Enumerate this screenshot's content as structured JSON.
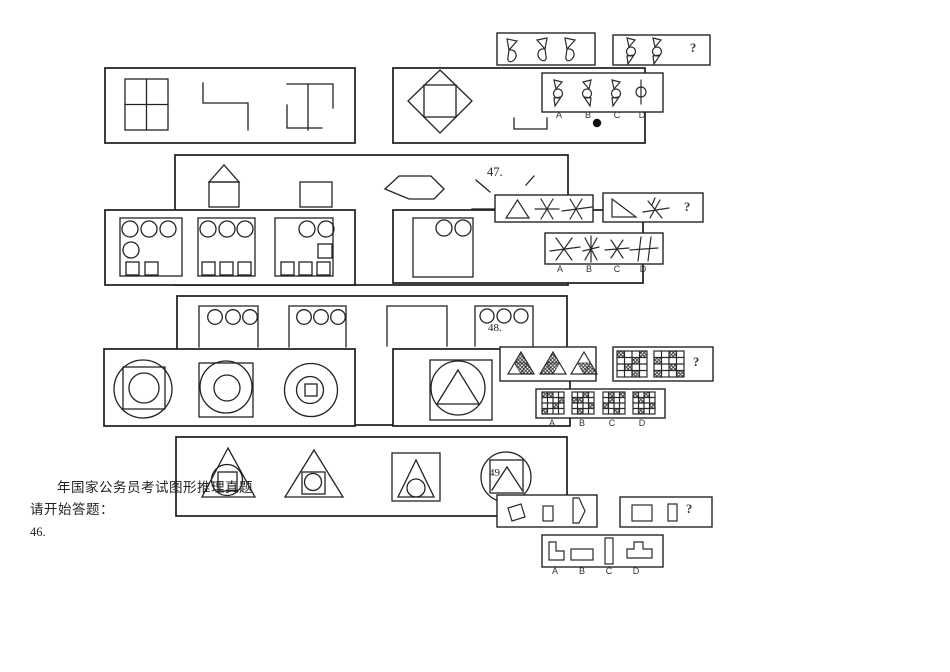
{
  "document": {
    "heading": "年国家公务员考试图形推理真题",
    "start_prompt": "请开始答题：",
    "marker_bullet": "●"
  },
  "questions": {
    "q46": {
      "number": "46.",
      "mark": "?",
      "option_labels": [
        "A",
        "B",
        "C",
        "D"
      ],
      "figures": {
        "problem_panel_1": "three ribbon figures: small triangle over half-moon",
        "problem_panel_2": "two spinning-top figures (triangle, circle, triangle) then question mark",
        "options": "A, B, C spinning-top variants; D is a circle on a vertical line",
        "marks": "open bracket under panel, solid dot under option B"
      }
    },
    "q47": {
      "number": "47.",
      "mark": "?",
      "option_labels": [
        "A",
        "B",
        "C",
        "D"
      ],
      "figures": {
        "problem_panel_1": "triangle, six-ray asterisk, six-ray asterisk with horizontal strike",
        "problem_panel_2": "right triangle, struck asterisk, question mark",
        "options": "four star/asterisk line figures, D is double vertical with strike"
      }
    },
    "q48": {
      "number": "48.",
      "mark": "?",
      "option_labels": [
        "A",
        "B",
        "C",
        "D"
      ],
      "figures": {
        "problem_panel_1": "three triangles subdivided into four cells with hatched cells",
        "problem_panel_2": "two 4x4 grids with hatched cells, question mark",
        "options": "four 4x4 grids with hatched cells"
      }
    },
    "q49": {
      "number": "49.",
      "mark": "?",
      "option_labels": [
        "A",
        "B",
        "C",
        "D"
      ],
      "figures": {
        "problem_panel_1": "slanted quadrilateral, small rectangle, pentagon",
        "problem_panel_2": "square, narrow rectangle, question mark",
        "options": "L-shape, flat rectangle, tall rectangle, stepped T-shape"
      }
    }
  },
  "left_panels": {
    "row1_left": "window grid square, stepped polyline, I-beam strokes",
    "row1_right": "diamond with inscribed square",
    "row2_above": "house figure, rectangle, flattened hexagon",
    "row2_left": "three squares holding circles and small squares",
    "row2_right": "square with two circles",
    "row3_above": "open boxes with three circles, empty open box",
    "row3_left": "circle-square-circle, square-circle-circle, circle-circle-square nests",
    "row3_right": "square, circle, triangle nested",
    "row4": "triangle-circle-square, triangle-square-circle, square-triangle-circle, circle-square-chevron"
  }
}
